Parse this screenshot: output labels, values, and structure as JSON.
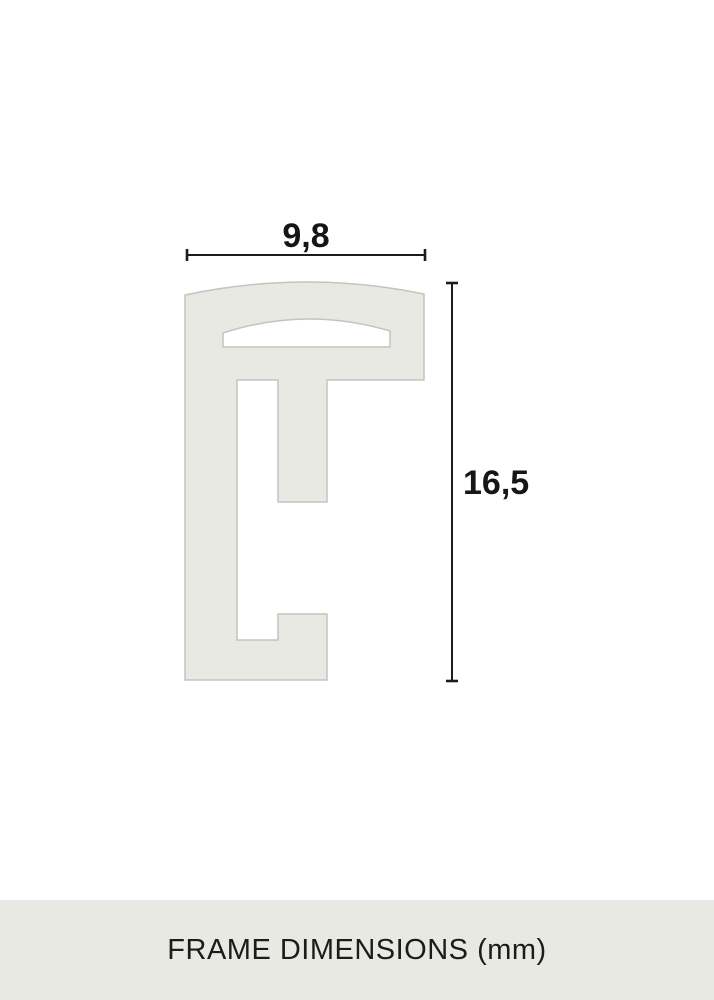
{
  "diagram": {
    "type": "frame-profile-cross-section",
    "width_label": "9,8",
    "height_label": "16,5",
    "unit": "mm",
    "profile_fill": "#e9e9e4",
    "profile_stroke": "#c3c3bf",
    "dimension_line_color": "#1c1c1c"
  },
  "footer": {
    "caption": "FRAME DIMENSIONS (mm)",
    "background": "#e9e9e4",
    "text_color": "#1c1c1c"
  },
  "chart_data": {
    "type": "table",
    "title": "FRAME DIMENSIONS (mm)",
    "dimensions": [
      {
        "name": "profile width",
        "value_mm": 9.8
      },
      {
        "name": "profile depth",
        "value_mm": 16.5
      }
    ]
  }
}
